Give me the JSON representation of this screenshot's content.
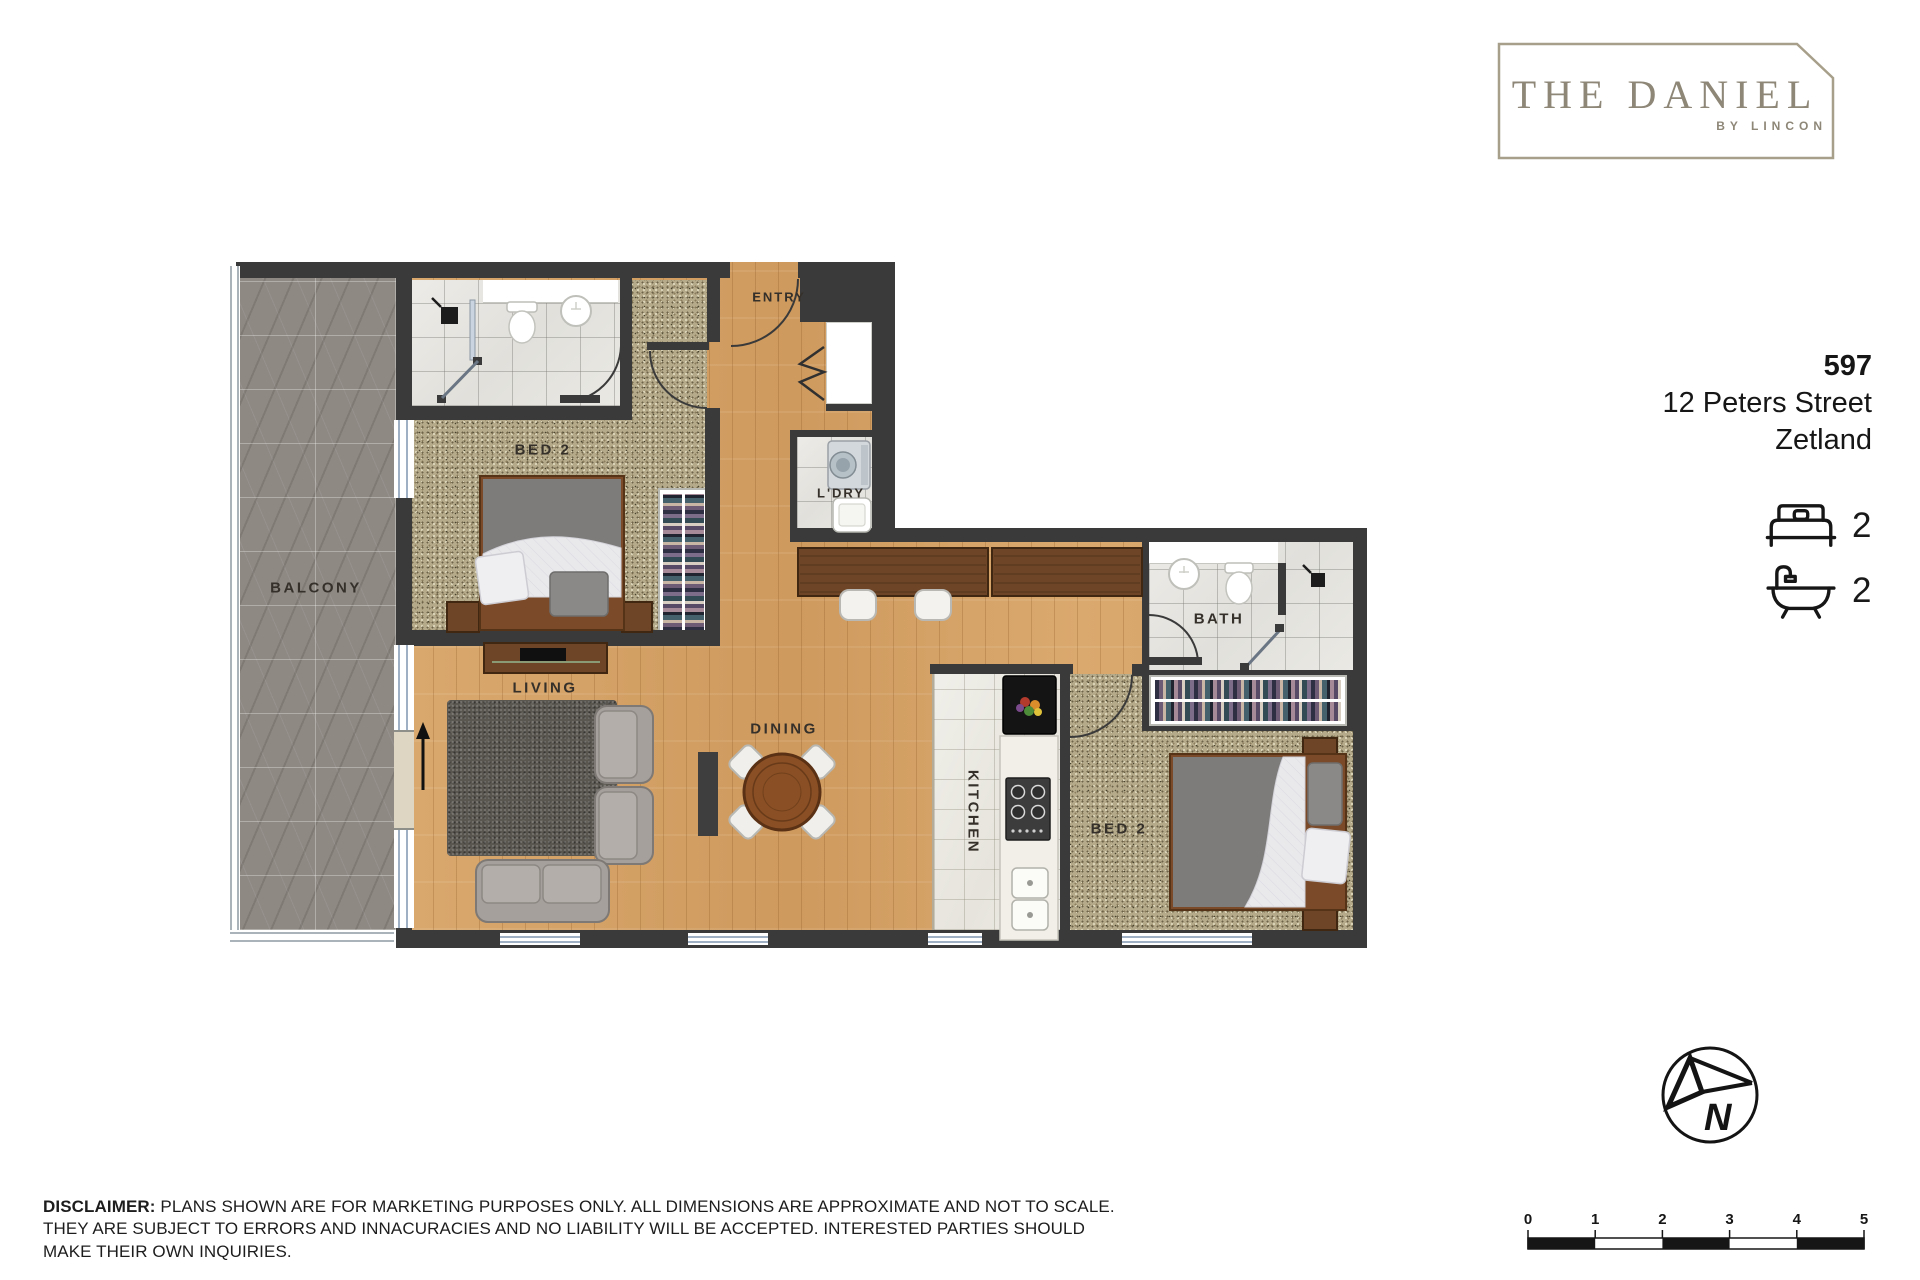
{
  "logo": {
    "title": "THE DANIEL",
    "subtitle": "BY LINCON"
  },
  "address": {
    "unit": "597",
    "street": "12 Peters Street",
    "suburb": "Zetland"
  },
  "stats": {
    "beds": "2",
    "baths": "2"
  },
  "rooms": {
    "balcony": "BALCONY",
    "bed2_top": "BED 2",
    "entry": "ENTRY",
    "laundry": "L'DRY",
    "bath": "BATH",
    "living": "LIVING",
    "dining": "DINING",
    "kitchen": "KITCHEN",
    "bed2_right": "BED 2"
  },
  "compass": {
    "north": "N"
  },
  "scale_bar": {
    "ticks": [
      "0",
      "1",
      "2",
      "3",
      "4",
      "5"
    ]
  },
  "disclaimer": {
    "label": "DISCLAIMER:",
    "text": "PLANS SHOWN ARE FOR MARKETING PURPOSES ONLY. ALL DIMENSIONS ARE APPROXIMATE AND NOT TO SCALE. THEY ARE SUBJECT TO ERRORS AND INNACURACIES AND NO LIABILITY WILL BE ACCEPTED. INTERESTED PARTIES SHOULD MAKE THEIR OWN INQUIRIES."
  },
  "colors": {
    "brand": "#8e8778",
    "wall": "#3a3a3a",
    "wood_floor": "#d6a468",
    "carpet": "#b5aa8a",
    "balcony_stone": "#8e8983",
    "tile": "#e7e6e2",
    "window": "#9fb0c4"
  }
}
